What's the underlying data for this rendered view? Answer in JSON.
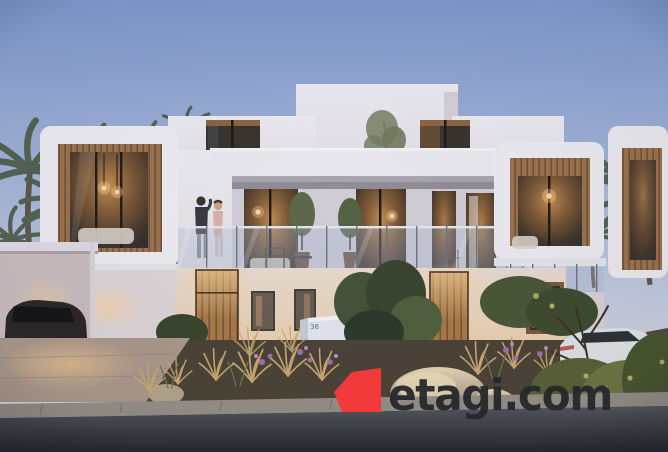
{
  "watermark": {
    "text": "etagi.com",
    "flag_color": "#f23a3a",
    "text_color": "#26282c"
  },
  "signage": {
    "unit_left": "36",
    "unit_right": "37"
  },
  "icons": {
    "etagi_flag_icon": "red-banner-polygon"
  },
  "palette": {
    "sky_top": "#7f98cc",
    "sky_mid": "#aab9da",
    "sky_horizon": "#e3dcd8",
    "wall_light": "#edecf2",
    "wall_shade": "#d8d4dc",
    "wood_slat": "#9a7350",
    "window_glow": "#f2c48a",
    "glass_tint": "#a9b8cc",
    "foliage_dark": "#3e4a34",
    "foliage_olive": "#6b7a52",
    "flower_purple": "#a272aa",
    "rock_light": "#e2d2b2",
    "road_dark": "#2e3035",
    "car_white": "#dfe2e4",
    "car_dark": "#2c2826"
  }
}
